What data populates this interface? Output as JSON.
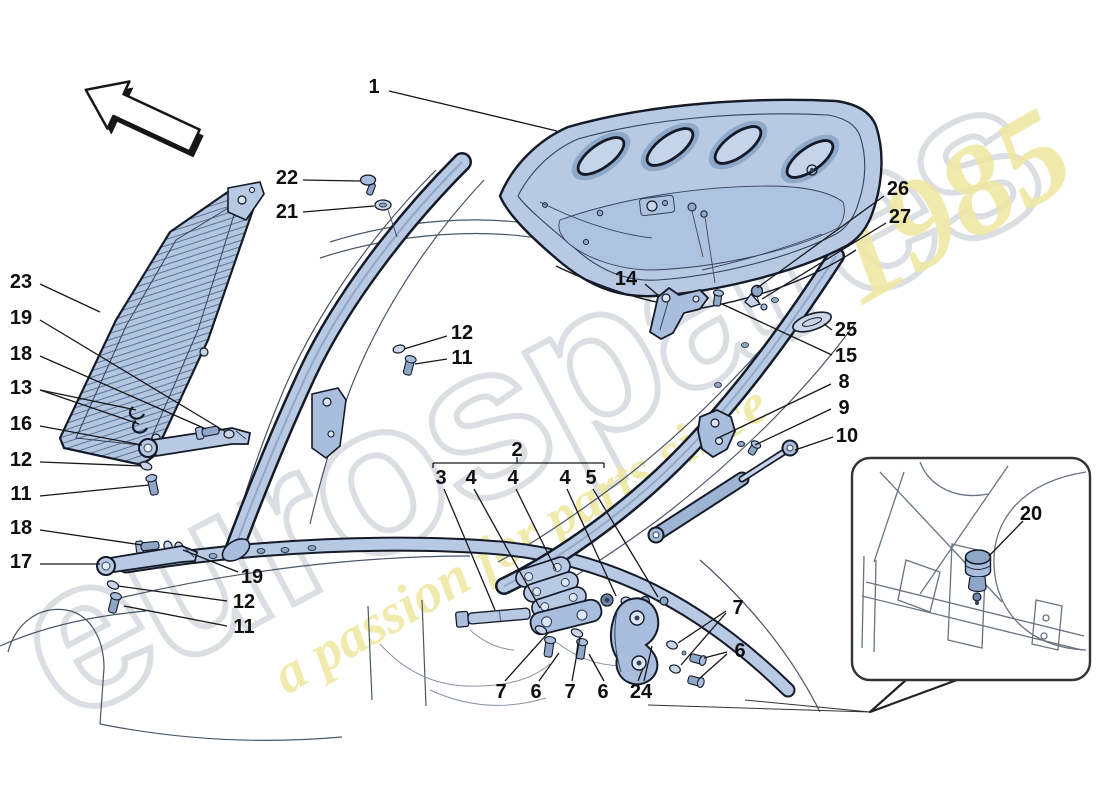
{
  "document": {
    "kind": "parts-diagram",
    "background": "#ffffff"
  },
  "watermark": {
    "brand_text": "eurospares",
    "slogan_text": "a passion for parts since",
    "slogan_year": "1985",
    "brand_outline_color": "#dadde2",
    "slogan_color": "#efe9a2"
  },
  "colors": {
    "part_fill": "#b7c9e3",
    "part_mid": "#8fa7c6",
    "part_pale": "#c9d6ea",
    "outline": "#141a28",
    "leader": "#17171a"
  },
  "inset": {
    "box": {
      "x": 852,
      "y": 458,
      "w": 238,
      "h": 222,
      "r": 18
    }
  },
  "callouts": [
    {
      "n": "1",
      "x": 374,
      "y": 87,
      "lines": [
        [
          389,
          91,
          557,
          131
        ]
      ]
    },
    {
      "n": "22",
      "x": 287,
      "y": 178,
      "lines": [
        [
          303,
          180,
          360,
          181
        ]
      ]
    },
    {
      "n": "21",
      "x": 287,
      "y": 212,
      "lines": [
        [
          303,
          212,
          374,
          206
        ]
      ]
    },
    {
      "n": "23",
      "x": 21,
      "y": 282,
      "lines": [
        [
          40,
          284,
          100,
          312
        ]
      ]
    },
    {
      "n": "19",
      "x": 21,
      "y": 318,
      "lines": [
        [
          40,
          320,
          226,
          432
        ]
      ]
    },
    {
      "n": "18",
      "x": 21,
      "y": 354,
      "lines": [
        [
          40,
          356,
          206,
          429
        ]
      ]
    },
    {
      "n": "13",
      "x": 21,
      "y": 388,
      "lines": [
        [
          40,
          390,
          136,
          410
        ],
        [
          40,
          390,
          139,
          424
        ]
      ]
    },
    {
      "n": "16",
      "x": 21,
      "y": 424,
      "lines": [
        [
          40,
          426,
          142,
          445
        ]
      ]
    },
    {
      "n": "12",
      "x": 21,
      "y": 460,
      "lines": [
        [
          40,
          462,
          142,
          466
        ]
      ]
    },
    {
      "n": "11",
      "x": 21,
      "y": 494,
      "lines": [
        [
          40,
          496,
          149,
          485
        ]
      ]
    },
    {
      "n": "18",
      "x": 21,
      "y": 528,
      "lines": [
        [
          40,
          530,
          142,
          545
        ]
      ]
    },
    {
      "n": "17",
      "x": 21,
      "y": 562,
      "lines": [
        [
          40,
          564,
          100,
          564
        ]
      ]
    },
    {
      "n": "26",
      "x": 898,
      "y": 189,
      "lines": [
        [
          884,
          196,
          757,
          288
        ]
      ]
    },
    {
      "n": "27",
      "x": 900,
      "y": 217,
      "lines": [
        [
          886,
          223,
          762,
          299
        ]
      ]
    },
    {
      "n": "14",
      "x": 626,
      "y": 279,
      "lines": [
        [
          645,
          284,
          659,
          296
        ]
      ]
    },
    {
      "n": "25",
      "x": 846,
      "y": 330,
      "lines": [
        [
          832,
          330,
          824,
          324
        ]
      ]
    },
    {
      "n": "15",
      "x": 846,
      "y": 356,
      "lines": [
        [
          832,
          355,
          722,
          304
        ]
      ]
    },
    {
      "n": "8",
      "x": 844,
      "y": 382,
      "lines": [
        [
          831,
          384,
          718,
          438
        ]
      ]
    },
    {
      "n": "9",
      "x": 844,
      "y": 408,
      "lines": [
        [
          831,
          409,
          755,
          445
        ]
      ]
    },
    {
      "n": "10",
      "x": 847,
      "y": 436,
      "lines": [
        [
          833,
          437,
          795,
          450
        ]
      ]
    },
    {
      "n": "12",
      "x": 462,
      "y": 333,
      "lines": [
        [
          447,
          336,
          404,
          349
        ]
      ]
    },
    {
      "n": "11",
      "x": 462,
      "y": 358,
      "lines": [
        [
          447,
          359,
          415,
          364
        ]
      ]
    },
    {
      "n": "2",
      "x": 517,
      "y": 450,
      "lines": [
        [
          433,
          468,
          433,
          463
        ],
        [
          433,
          463,
          604,
          463
        ],
        [
          604,
          463,
          604,
          468
        ],
        [
          517,
          463,
          517,
          457
        ]
      ]
    },
    {
      "n": "3",
      "x": 441,
      "y": 478,
      "lines": [
        [
          444,
          489,
          495,
          610
        ]
      ]
    },
    {
      "n": "4",
      "x": 471,
      "y": 478,
      "lines": [
        [
          474,
          489,
          540,
          608
        ]
      ]
    },
    {
      "n": "4",
      "x": 513,
      "y": 478,
      "lines": [
        [
          516,
          489,
          556,
          570
        ]
      ]
    },
    {
      "n": "4",
      "x": 565,
      "y": 478,
      "lines": [
        [
          567,
          489,
          616,
          596
        ]
      ]
    },
    {
      "n": "5",
      "x": 591,
      "y": 478,
      "lines": [
        [
          593,
          489,
          658,
          597
        ]
      ]
    },
    {
      "n": "19",
      "x": 252,
      "y": 577,
      "lines": [
        [
          238,
          572,
          183,
          550
        ]
      ]
    },
    {
      "n": "12",
      "x": 244,
      "y": 602,
      "lines": [
        [
          227,
          601,
          118,
          586
        ]
      ]
    },
    {
      "n": "11",
      "x": 244,
      "y": 627,
      "lines": [
        [
          227,
          626,
          124,
          606
        ]
      ]
    },
    {
      "n": "7",
      "x": 501,
      "y": 692,
      "lines": [
        [
          505,
          681,
          548,
          633
        ]
      ]
    },
    {
      "n": "6",
      "x": 536,
      "y": 692,
      "lines": [
        [
          539,
          681,
          559,
          653
        ]
      ]
    },
    {
      "n": "7",
      "x": 570,
      "y": 692,
      "lines": [
        [
          572,
          681,
          580,
          637
        ]
      ]
    },
    {
      "n": "6",
      "x": 603,
      "y": 692,
      "lines": [
        [
          604,
          681,
          589,
          654
        ]
      ]
    },
    {
      "n": "24",
      "x": 641,
      "y": 692,
      "lines": [
        [
          638,
          681,
          643,
          668
        ],
        [
          644,
          681,
          652,
          646
        ]
      ]
    },
    {
      "n": "7",
      "x": 738,
      "y": 608,
      "lines": [
        [
          726,
          611,
          678,
          643
        ],
        [
          726,
          613,
          681,
          665
        ]
      ]
    },
    {
      "n": "6",
      "x": 740,
      "y": 651,
      "lines": [
        [
          727,
          652,
          704,
          658
        ],
        [
          727,
          654,
          700,
          678
        ]
      ]
    },
    {
      "n": "20",
      "x": 1031,
      "y": 514,
      "lines": [
        [
          1023,
          521,
          989,
          556
        ]
      ]
    }
  ]
}
